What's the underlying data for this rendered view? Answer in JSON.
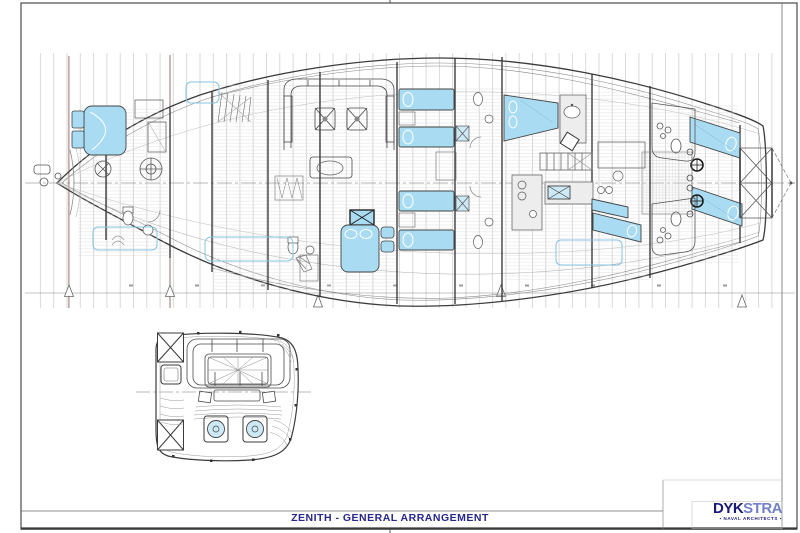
{
  "page": {
    "background": "#ffffff",
    "frame_color": "#4a4a4a"
  },
  "title_block": {
    "title": "ZENITH - GENERAL ARRANGEMENT",
    "title_color": "#26268c"
  },
  "logo": {
    "name_primary": "DYK",
    "name_secondary": "STRA",
    "tagline": "NAVAL ARCHITECTS",
    "primary_color": "#1a1a78",
    "secondary_color": "#7280c8"
  },
  "drawing": {
    "type": "yacht-general-arrangement-plan",
    "views": [
      "main-interior-plan",
      "cockpit-detail-plan"
    ],
    "furniture_color": "#a9dbf2",
    "window_color": "#85c4e3",
    "grid_color": "#c9c9c9",
    "datum_line_color": "#9b7272",
    "station_triangles_x": [
      69,
      170,
      318,
      501,
      742
    ]
  }
}
